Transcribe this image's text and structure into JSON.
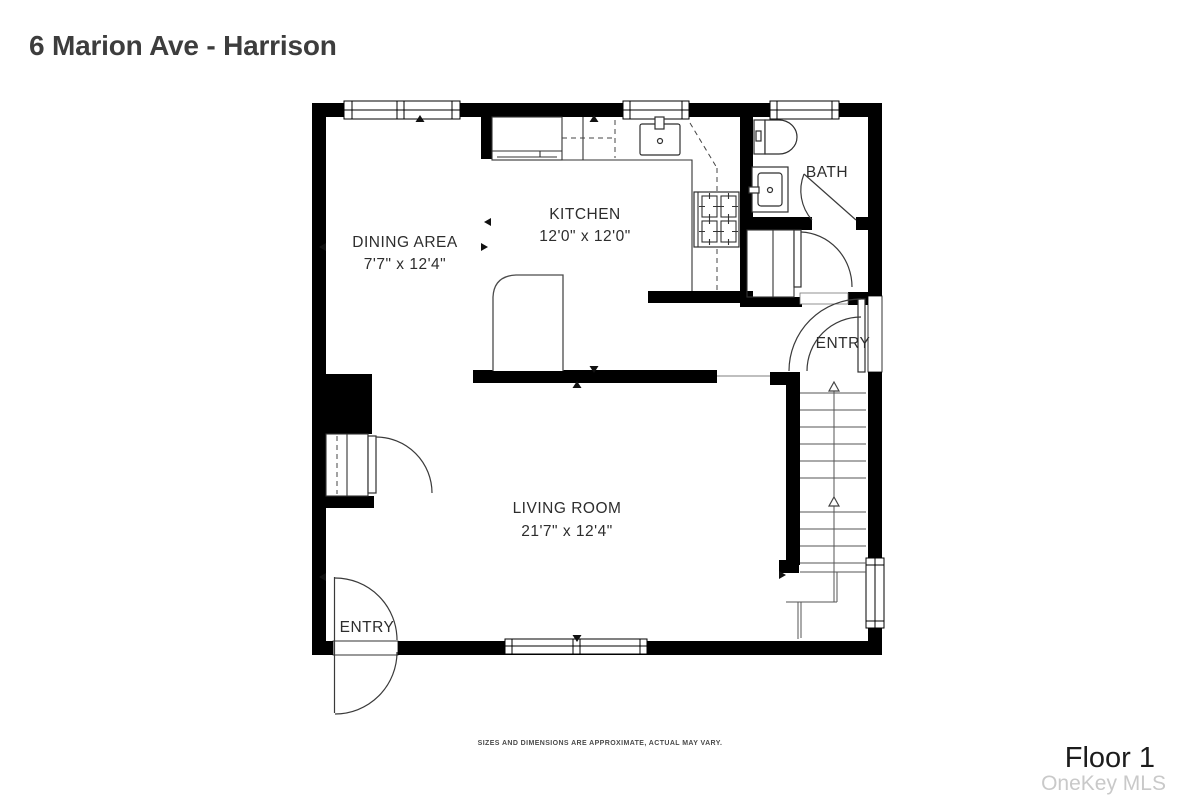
{
  "header": {
    "title": "6 Marion Ave - Harrison"
  },
  "rooms": {
    "dining": {
      "name": "DINING AREA",
      "dims": "7'7\" x 12'4\""
    },
    "kitchen": {
      "name": "KITCHEN",
      "dims": "12'0\" x 12'0\""
    },
    "bath": {
      "name": "BATH"
    },
    "living": {
      "name": "LIVING ROOM",
      "dims": "21'7\" x 12'4\""
    },
    "entry_side": {
      "name": "ENTRY"
    },
    "entry_front": {
      "name": "ENTRY"
    }
  },
  "footer": {
    "disclaimer": "SIZES AND DIMENSIONS ARE APPROXIMATE, ACTUAL MAY VARY.",
    "floor_label": "Floor 1",
    "watermark": "OneKey MLS"
  },
  "colors": {
    "wall": "#000000",
    "label_text": "#2d2d2d",
    "watermark": "#c9c9c9"
  }
}
